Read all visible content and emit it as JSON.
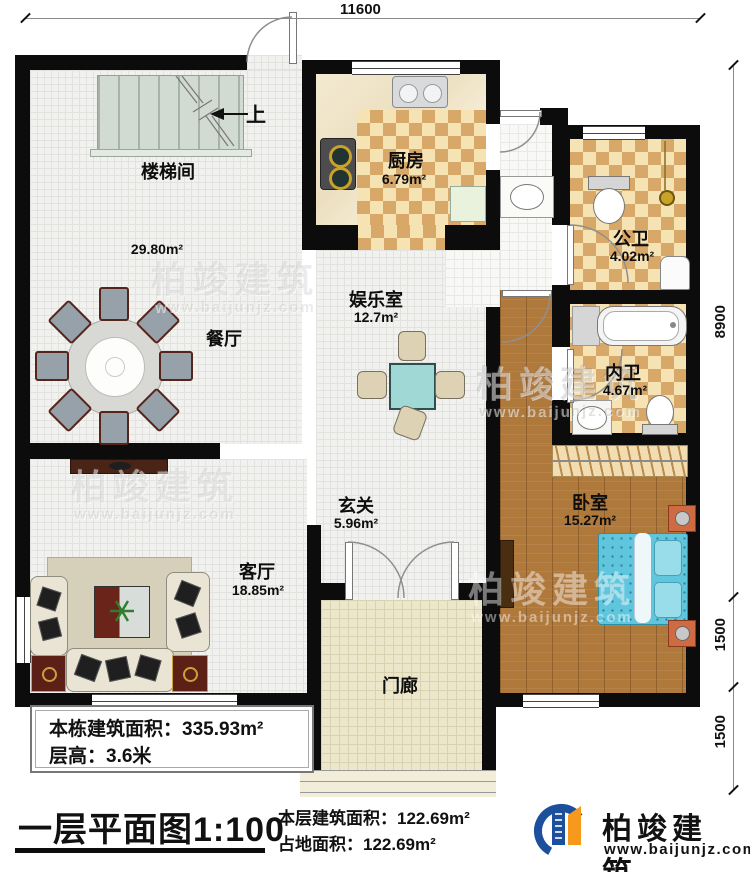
{
  "dimensions": {
    "top": "11600",
    "right": [
      "8900",
      "1500",
      "1500"
    ]
  },
  "rooms": {
    "stairwell": {
      "label": "楼梯间"
    },
    "stairs_up": {
      "label": "上"
    },
    "hall": {
      "area": "29.80m²"
    },
    "dining": {
      "label": "餐厅"
    },
    "kitchen": {
      "label": "厨房",
      "area": "6.79m²"
    },
    "public_bath": {
      "label": "公卫",
      "area": "4.02m²"
    },
    "inner_bath": {
      "label": "内卫",
      "area": "4.67m²"
    },
    "entertainment": {
      "label": "娱乐室",
      "area": "12.7m²"
    },
    "foyer": {
      "label": "玄关",
      "area": "5.96m²"
    },
    "living": {
      "label": "客厅",
      "area": "18.85m²"
    },
    "bedroom": {
      "label": "卧室",
      "area": "15.27m²"
    },
    "porch": {
      "label": "门廊"
    }
  },
  "annotations": {
    "building_area_line": "本栋建筑面积：335.93m²",
    "floor_height_line": "层高：3.6米",
    "plan_title": "一层平面图1:100",
    "floor_area_line": "本层建筑面积：122.69m²",
    "footprint_line": "占地面积：122.69m²"
  },
  "logo": {
    "name": "柏竣建筑",
    "website": "www.baijunjz.com"
  },
  "watermark": {
    "name": "柏竣建筑",
    "website": "www.baijunjz.com"
  },
  "colors": {
    "wall": "#0c0c0c",
    "checker_dark": "#d8a868",
    "checker_light": "#f6e3b4",
    "wood": "#b0793c",
    "bed_blue": "#5fc6dd",
    "logo_blue": "#1c4f9c",
    "logo_orange": "#f6991d"
  }
}
